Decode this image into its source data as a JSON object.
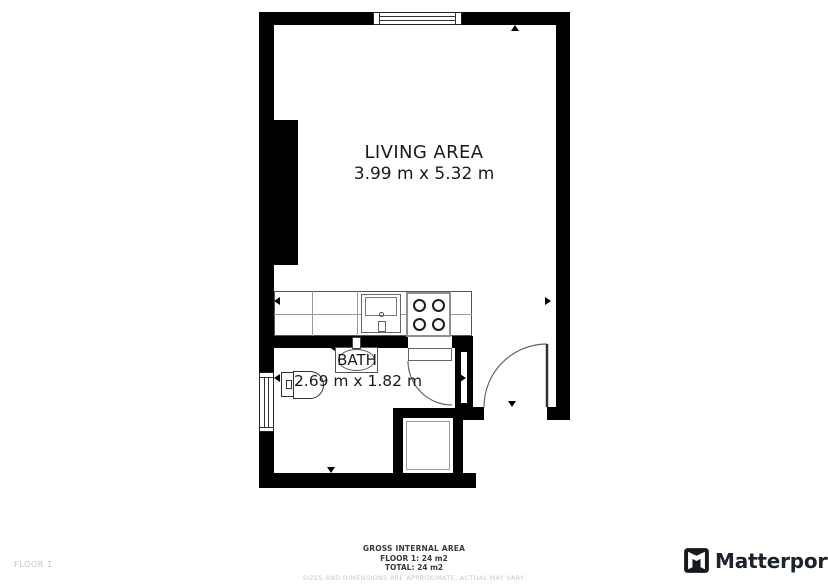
{
  "plan": {
    "rooms": [
      {
        "id": "living",
        "name": "LIVING AREA",
        "dimensions": "3.99 m x 5.32 m"
      },
      {
        "id": "bath",
        "name": "BATH",
        "dimensions": "2.69 m x 1.82 m"
      }
    ],
    "fixtures": [
      "kitchen-counter",
      "kitchen-sink",
      "stove-4-burners",
      "toilet",
      "bathroom-sink",
      "shower",
      "window-top",
      "window-bath",
      "door-bath",
      "door-entry"
    ]
  },
  "footer": {
    "floor_label": "FLOOR 1",
    "summary": {
      "title": "GROSS INTERNAL AREA",
      "floor_line": "FLOOR 1: 24 m2",
      "total_line": "TOTAL: 24 m2",
      "disclaimer": "SIZES AND DIMENSIONS ARE APPROXIMATE, ACTUAL MAY VARY."
    },
    "brand": {
      "name": "Matterport"
    }
  },
  "colors": {
    "wall": "#000000",
    "room_text": "#1a1a1a",
    "summary_text": "#3a3a3a",
    "muted_text": "#c9c9c9",
    "brand_text": "#1d232b"
  }
}
